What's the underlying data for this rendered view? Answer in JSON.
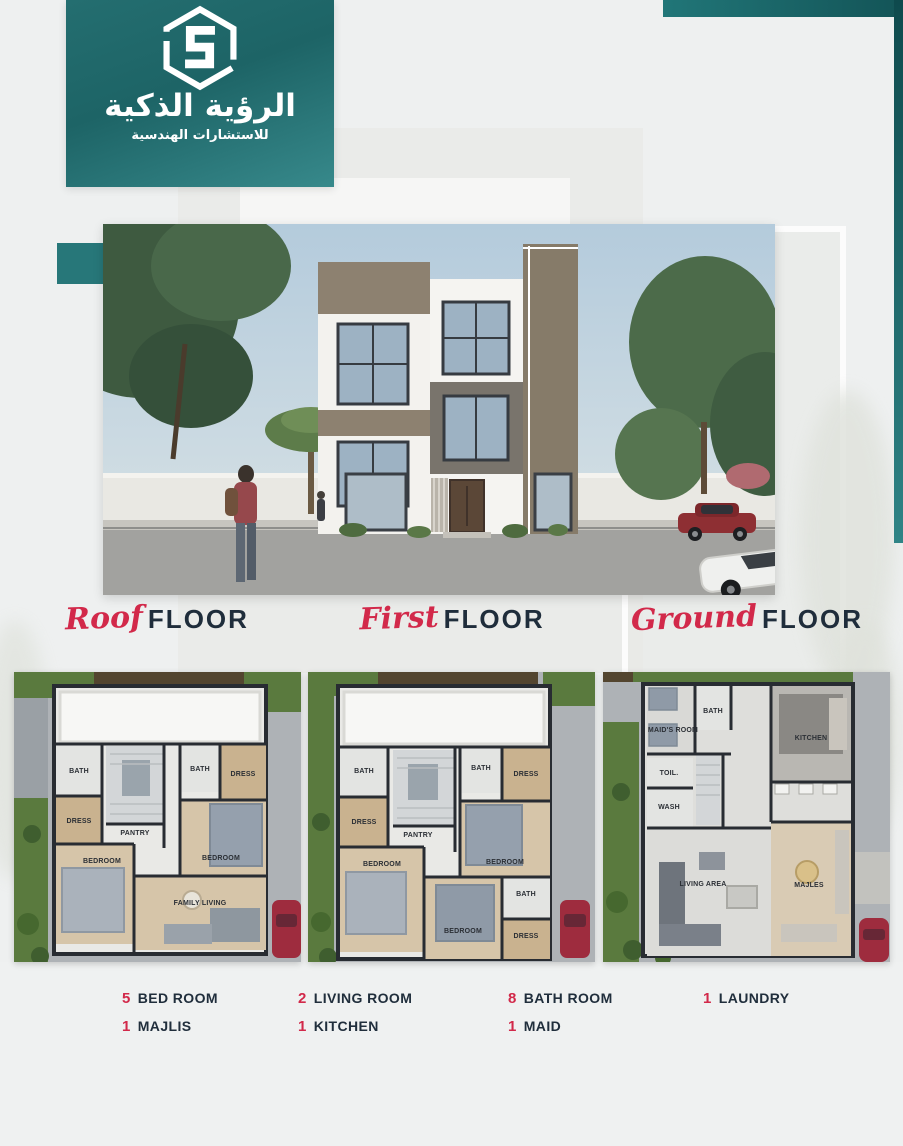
{
  "colors": {
    "teal": "#226c6e",
    "accent_red": "#d2294a",
    "navy": "#1f2d3b"
  },
  "brand": {
    "icon": "hexagon-s-logo",
    "title_ar": "الرؤية الذكية",
    "subtitle_ar": "للاستشارات الهندسية"
  },
  "floor_labels": [
    {
      "script": "Roof",
      "word": "FLOOR"
    },
    {
      "script": "First",
      "word": "FLOOR"
    },
    {
      "script": "Ground",
      "word": "FLOOR"
    }
  ],
  "plans": [
    {
      "name": "roof-floor-plan",
      "rooms": {
        "bath_left": "BATH",
        "dress_left": "DRESS",
        "bath_right": "BATH",
        "dress_right": "DRESS",
        "pantry": "PANTRY",
        "bedroom_left": "BEDROOM",
        "bedroom_right": "BEDROOM",
        "family_living": "FAMILY LIVING"
      }
    },
    {
      "name": "first-floor-plan",
      "rooms": {
        "bath_left": "BATH",
        "dress_left": "DRESS",
        "bath_mid": "BATH",
        "dress_right": "DRESS",
        "pantry": "PANTRY",
        "bedroom_left": "BEDROOM",
        "bedroom_right": "BEDROOM",
        "bedroom_bottom": "BEDROOM",
        "bath_bottom": "BATH",
        "dress_bottom": "DRESS"
      }
    },
    {
      "name": "ground-floor-plan",
      "rooms": {
        "maids_room": "MAID'S ROOM",
        "bath": "BATH",
        "kitchen": "KITCHEN",
        "toilet": "TOIL.",
        "wash": "WASH",
        "living_area": "LIVING AREA",
        "majles": "MAJLES"
      }
    }
  ],
  "stats": [
    {
      "count": "5",
      "label": "BED ROOM"
    },
    {
      "count": "1",
      "label": "MAJLIS"
    },
    {
      "count": "2",
      "label": "LIVING ROOM"
    },
    {
      "count": "1",
      "label": "KITCHEN"
    },
    {
      "count": "8",
      "label": "BATH ROOM"
    },
    {
      "count": "1",
      "label": "MAID"
    },
    {
      "count": "1",
      "label": "LAUNDRY"
    }
  ]
}
